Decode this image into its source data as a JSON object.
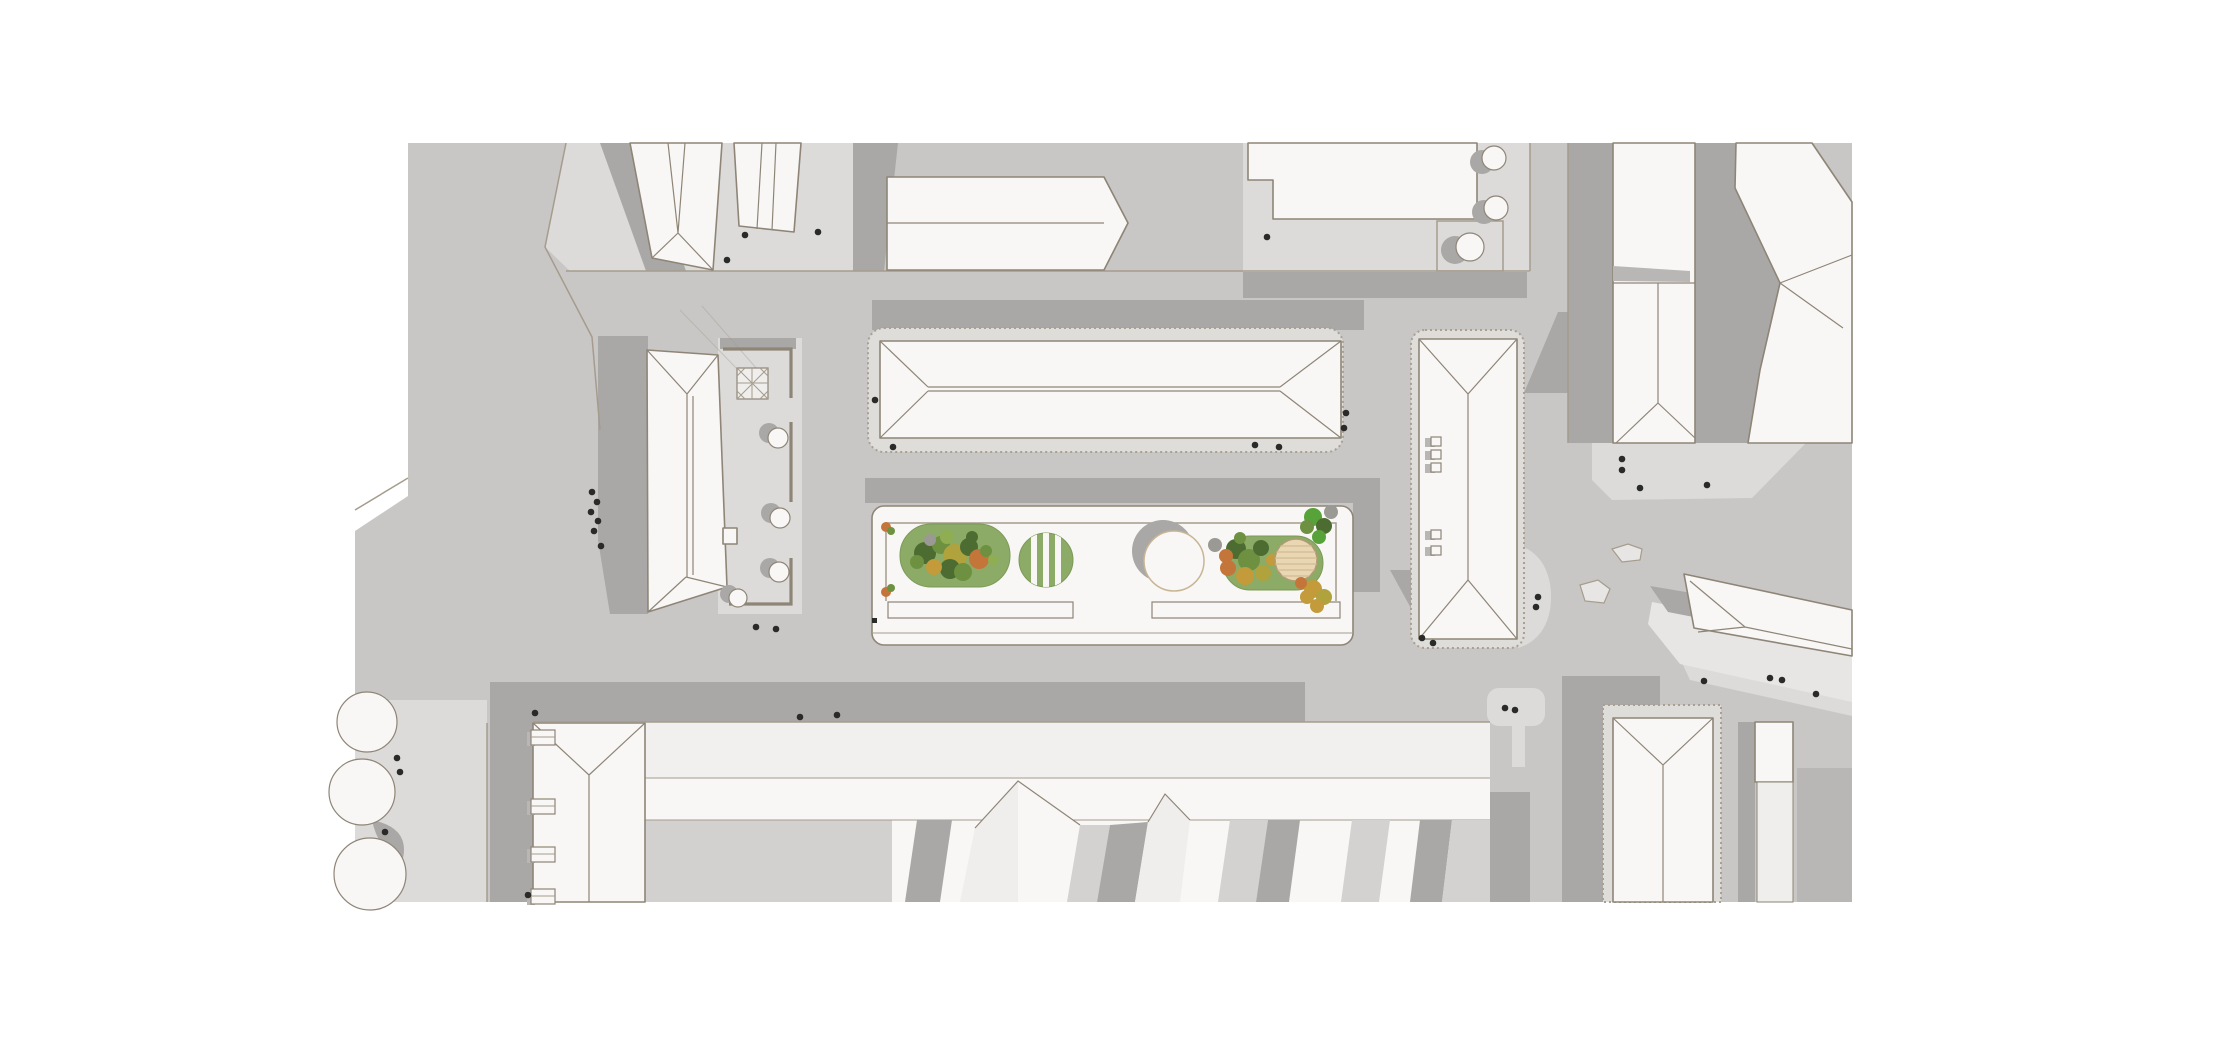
{
  "meta": {
    "width": 2220,
    "height": 1037,
    "title": "Top-down architectural site plan rendering of an urban block with a central linear pocket plaza",
    "visible_text": "none"
  },
  "colors": {
    "page_bg": "#ffffff",
    "ground": "#c8c7c5",
    "plaza_light": "#dcdbd9",
    "plaza_lighter": "#e7e6e4",
    "shadow": "#a9a8a6",
    "shadow_soft": "#b8b7b5",
    "building_fill": "#f8f7f5",
    "building_face": "#efeeec",
    "roof_band_light": "#f1f0ee",
    "courtyard": "#d2d1cf",
    "stripe_mid": "#d3d2d0",
    "outline": "#8e8577",
    "roof_seam": "#a59c8d",
    "curb": "#a59c8d",
    "stipple_fill": "#deddda",
    "stipple_stroke": "#a9a093",
    "wall": "#8e8577",
    "lawn": "#8cab66",
    "lawn_edge": "#7d9a58",
    "tree_dark": "#4c6c31",
    "tree_green": "#6d9140",
    "tree_light": "#8fae52",
    "tree_olive": "#b0a23c",
    "tree_orange": "#c4763a",
    "tree_gold": "#c39b3a",
    "shrub_bright": "#58a23a",
    "blob_gray": "#9b9993",
    "deck": "#e9d6b2",
    "deck_edge": "#b19a74",
    "deck_line": "#d6bf97",
    "person_dot": "#2a2a28",
    "rock": "#e7e6e4",
    "pavilion_edge": "#c7b694"
  },
  "scene": {
    "type": "architectural site plan rendering",
    "view": "top-down roof plan with cast shadows",
    "visible_text": "none",
    "central_plaza_features": [
      "west stadium-shaped lawn with mixed autumn tree cluster",
      "striped circular lawn",
      "circular pavilion casting a crescent shadow",
      "east stadium-shaped lawn with round timber deck",
      "two linear benches",
      "corner shrub plantings"
    ],
    "buildings": [
      "northwest angled slab pair",
      "north hipped-roof slab",
      "northeast flat-roof block with tree courtyard",
      "west hipped building with glass-lattice atrium, garden walls and cafe tables",
      "north-central long hipped bar on stippled apron",
      "east hipped bar with rooftop vents and curved forecourt",
      "south L-shaped block with dormers and folded striped roofscape",
      "southeast hipped tower and narrow slab",
      "east angled hipped slab",
      "far-east tall slab and bent tower cluster"
    ],
    "streets": "gray asphalt with curb lines, building shadows and scattered pedestrian dots",
    "counts": {
      "pedestrian_dots": 39,
      "cafe_tables": 4,
      "courtyard_trees": 3,
      "street_trees_southwest": 3,
      "rooftop_vents": 5,
      "benches": 2
    }
  },
  "people": {
    "dots": [
      [
        745,
        235
      ],
      [
        818,
        232
      ],
      [
        727,
        260
      ],
      [
        1267,
        237
      ],
      [
        875,
        400
      ],
      [
        893,
        447
      ],
      [
        1255,
        445
      ],
      [
        1279,
        447
      ],
      [
        1346,
        413
      ],
      [
        1344,
        428
      ],
      [
        592,
        492
      ],
      [
        597,
        502
      ],
      [
        591,
        512
      ],
      [
        598,
        521
      ],
      [
        594,
        531
      ],
      [
        601,
        546
      ],
      [
        756,
        627
      ],
      [
        776,
        629
      ],
      [
        800,
        717
      ],
      [
        837,
        715
      ],
      [
        535,
        713
      ],
      [
        397,
        758
      ],
      [
        400,
        772
      ],
      [
        385,
        832
      ],
      [
        528,
        895
      ],
      [
        1422,
        638
      ],
      [
        1433,
        643
      ],
      [
        1538,
        597
      ],
      [
        1536,
        607
      ],
      [
        1622,
        459
      ],
      [
        1622,
        470
      ],
      [
        1640,
        488
      ],
      [
        1707,
        485
      ],
      [
        1505,
        708
      ],
      [
        1515,
        710
      ],
      [
        1704,
        681
      ],
      [
        1770,
        678
      ],
      [
        1782,
        680
      ],
      [
        1816,
        694
      ]
    ]
  },
  "planting": {
    "lawn_west_trees": [
      [
        925,
        553,
        11,
        "tree_dark"
      ],
      [
        941,
        545,
        9,
        "tree_green"
      ],
      [
        955,
        556,
        12,
        "tree_olive"
      ],
      [
        969,
        547,
        9,
        "tree_dark"
      ],
      [
        979,
        559,
        10,
        "tree_orange"
      ],
      [
        950,
        569,
        10,
        "tree_dark"
      ],
      [
        934,
        567,
        8,
        "tree_gold"
      ],
      [
        963,
        572,
        9,
        "tree_green"
      ],
      [
        917,
        562,
        7,
        "tree_green"
      ],
      [
        947,
        537,
        7,
        "tree_light"
      ],
      [
        972,
        537,
        6,
        "tree_dark"
      ],
      [
        986,
        551,
        6,
        "tree_green"
      ],
      [
        930,
        540,
        6,
        "blob_gray"
      ],
      [
        993,
        560,
        5,
        "tree_light"
      ]
    ],
    "lawn_east_trees": [
      [
        1236,
        549,
        10,
        "tree_dark"
      ],
      [
        1249,
        560,
        11,
        "tree_green"
      ],
      [
        1228,
        568,
        8,
        "tree_orange"
      ],
      [
        1245,
        576,
        9,
        "tree_gold"
      ],
      [
        1261,
        548,
        8,
        "tree_dark"
      ],
      [
        1263,
        573,
        8,
        "tree_olive"
      ],
      [
        1226,
        556,
        7,
        "tree_orange"
      ],
      [
        1240,
        538,
        6,
        "tree_green"
      ],
      [
        1215,
        545,
        7,
        "blob_gray"
      ],
      [
        1272,
        560,
        6,
        "tree_gold"
      ]
    ],
    "plaza_shrubs": [
      [
        1313,
        517,
        9,
        "shrub_bright"
      ],
      [
        1324,
        526,
        8,
        "tree_dark"
      ],
      [
        1307,
        527,
        7,
        "tree_green"
      ],
      [
        1319,
        537,
        7,
        "shrub_bright"
      ],
      [
        1331,
        512,
        7,
        "blob_gray"
      ],
      [
        1313,
        589,
        9,
        "tree_gold"
      ],
      [
        1324,
        597,
        8,
        "tree_olive"
      ],
      [
        1307,
        597,
        7,
        "tree_gold"
      ],
      [
        1317,
        606,
        7,
        "tree_gold"
      ],
      [
        1301,
        583,
        6,
        "tree_orange"
      ],
      [
        886,
        527,
        5,
        "tree_orange"
      ],
      [
        891,
        531,
        4,
        "tree_green"
      ],
      [
        886,
        592,
        5,
        "tree_orange"
      ],
      [
        891,
        588,
        4,
        "tree_green"
      ]
    ],
    "ne_courtyard_tree_shadows": [
      [
        1482,
        162,
        12
      ],
      [
        1484,
        212,
        12
      ],
      [
        1455,
        250,
        14
      ]
    ],
    "ne_courtyard_trees": [
      [
        1494,
        158,
        12
      ],
      [
        1496,
        208,
        12
      ],
      [
        1470,
        247,
        14
      ]
    ],
    "cafe_table_shadows": [
      [
        769,
        433,
        10
      ],
      [
        771,
        513,
        10
      ],
      [
        770,
        568,
        10
      ],
      [
        729,
        594,
        9
      ]
    ],
    "cafe_tables": [
      [
        778,
        438,
        10
      ],
      [
        780,
        518,
        10
      ],
      [
        779,
        572,
        10
      ],
      [
        738,
        598,
        9
      ]
    ],
    "sw_street_trees": [
      [
        367,
        722,
        30
      ],
      [
        362,
        792,
        33
      ],
      [
        370,
        874,
        36
      ]
    ]
  }
}
